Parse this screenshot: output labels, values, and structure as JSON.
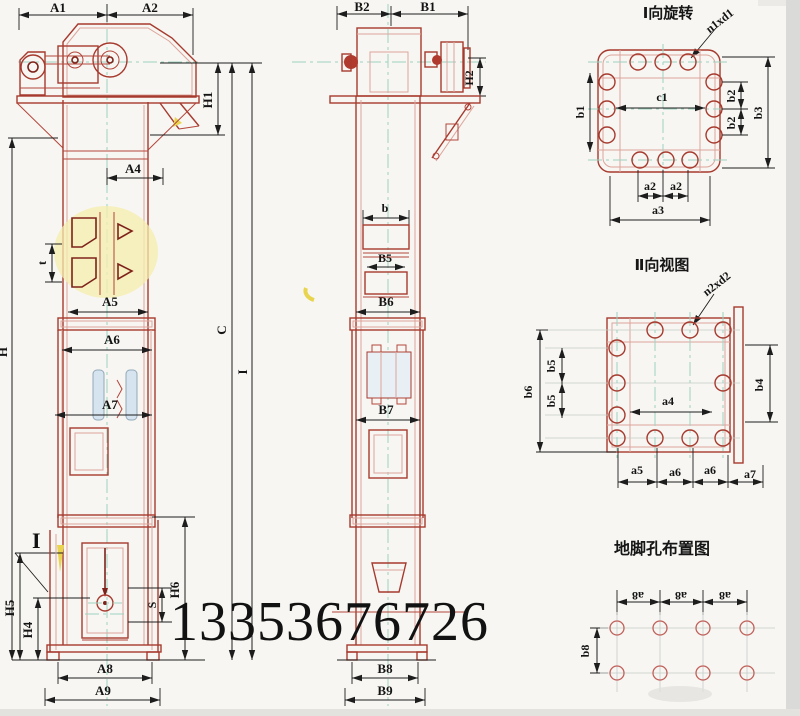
{
  "watermark": "13353676726",
  "front_view": {
    "labels": {
      "A1": "A1",
      "A2": "A2",
      "H1": "H1",
      "A4": "A4",
      "A5": "A5",
      "A6": "A6",
      "A7": "A7",
      "A8": "A8",
      "A9": "A9",
      "H": "H",
      "t": "t",
      "C": "C",
      "I": "I",
      "section_marker": "I",
      "H4": "H4",
      "H5": "H5",
      "H6": "H6",
      "S": "S"
    }
  },
  "side_view": {
    "labels": {
      "B2": "B2",
      "B1": "B1",
      "H2": "H2",
      "b": "b",
      "B5": "B5",
      "B6": "B6",
      "B7": "B7",
      "B8": "B8",
      "B9": "B9"
    }
  },
  "view_I": {
    "title": "Ⅰ向旋转",
    "leader": "n1xd1",
    "labels": {
      "c1": "c1",
      "b1": "b1",
      "b2": "b2",
      "b3": "b3",
      "a2": "a2",
      "a3": "a3"
    }
  },
  "view_II": {
    "title": "Ⅱ向视图",
    "leader": "n2xd2",
    "labels": {
      "a4": "a4",
      "b4": "b4",
      "b5": "b5",
      "b6": "b6",
      "a5": "a5",
      "a6": "a6",
      "a7": "a7"
    }
  },
  "foundation_view": {
    "title": "地脚孔布置图",
    "labels": {
      "a8": "a8",
      "b8": "b8"
    }
  }
}
